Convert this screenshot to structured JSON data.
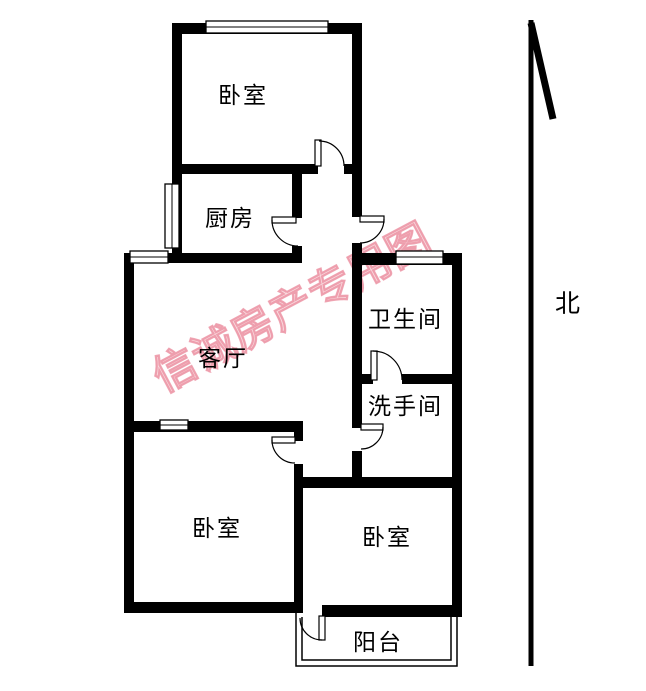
{
  "floorplan": {
    "watermark": {
      "text": "信诚房产专用图",
      "color": "#ec8fa0"
    },
    "compass": {
      "label": "北"
    },
    "colors": {
      "wall": "#000000",
      "background": "#ffffff"
    },
    "rooms": [
      {
        "name": "bedroom-north",
        "label": "卧室"
      },
      {
        "name": "kitchen",
        "label": "厨房"
      },
      {
        "name": "living-room",
        "label": "客厅"
      },
      {
        "name": "bathroom",
        "label": "卫生间"
      },
      {
        "name": "washroom",
        "label": "洗手间"
      },
      {
        "name": "bedroom-southwest",
        "label": "卧室"
      },
      {
        "name": "bedroom-southeast",
        "label": "卧室"
      },
      {
        "name": "balcony",
        "label": "阳台"
      }
    ]
  }
}
